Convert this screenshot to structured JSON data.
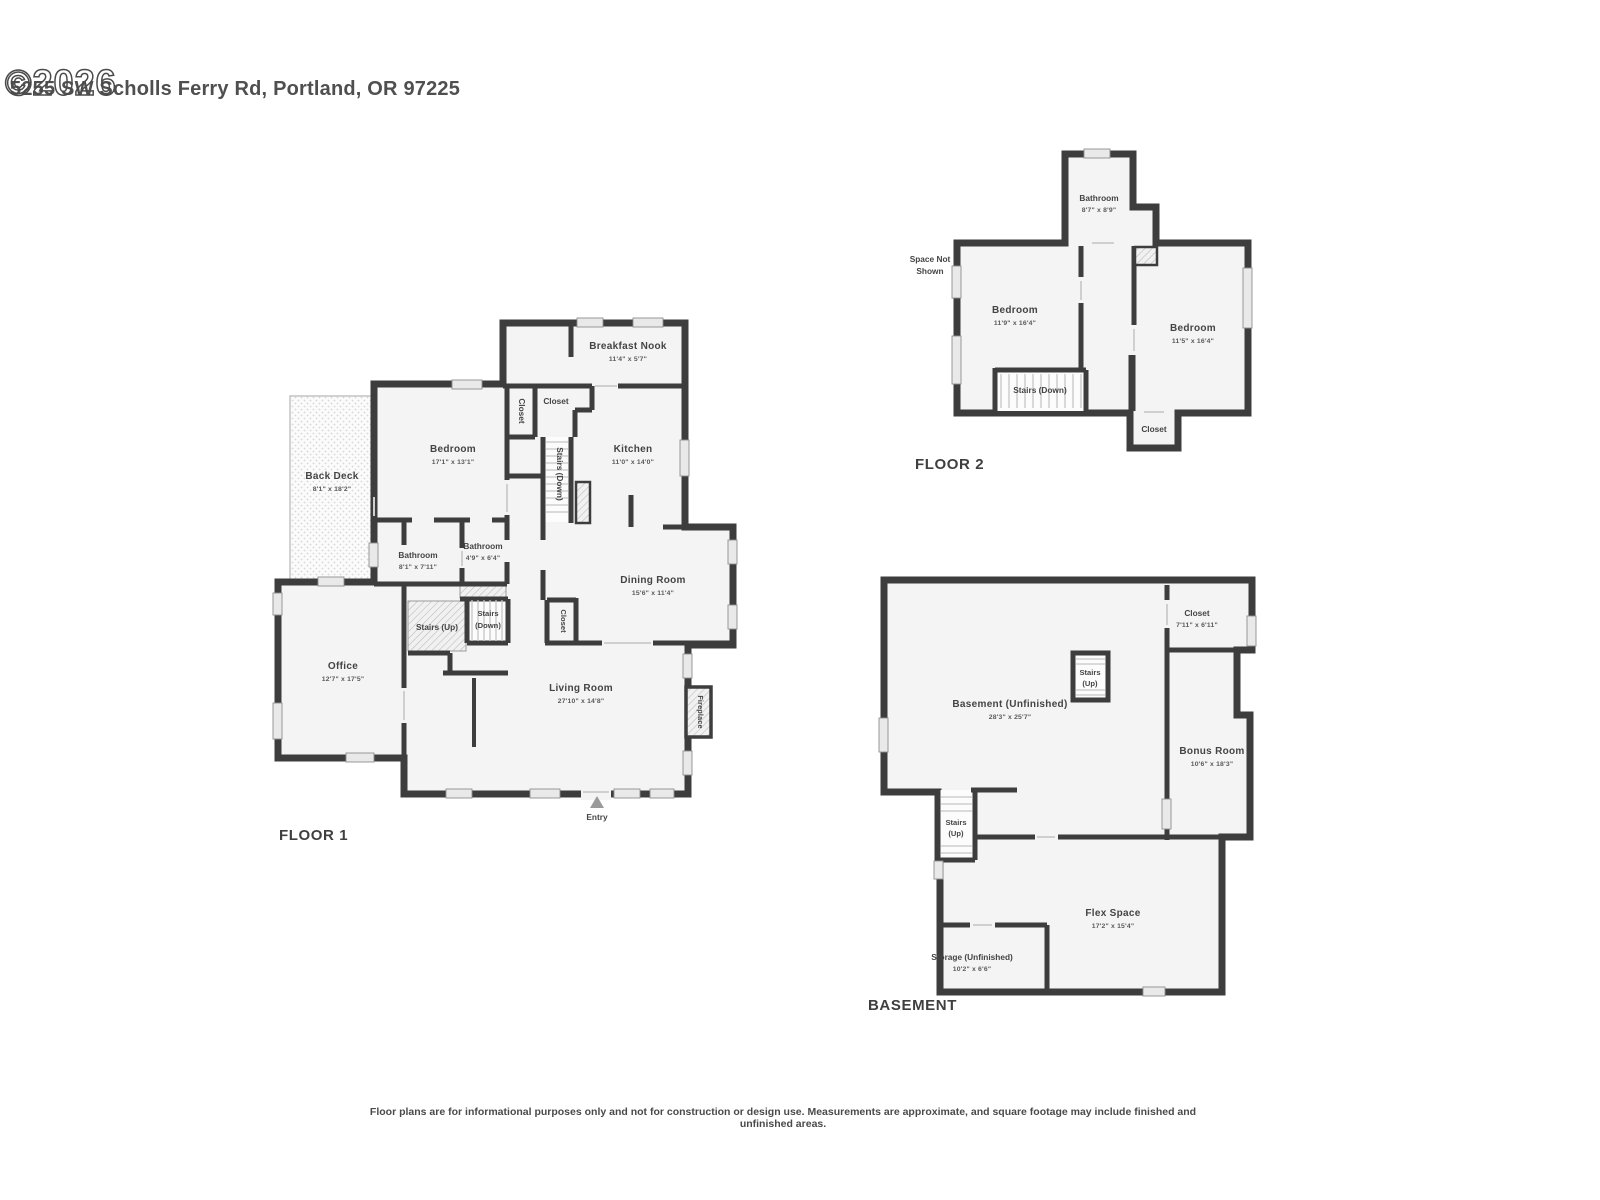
{
  "header": {
    "watermark": "©2026",
    "title": "5255 SW Scholls Ferry Rd, Portland, OR 97225"
  },
  "footer": {
    "disclaimer": "Floor plans are for informational purposes only and not for construction or design use. Measurements are approximate, and square footage may include finished and unfinished areas."
  },
  "colors": {
    "wall": "#3d3d3d",
    "room_fill": "#f4f4f4",
    "window": "#e9e9e9",
    "text": "#4a4a4a"
  },
  "floors": {
    "f1": {
      "label": "FLOOR 1",
      "rooms": {
        "breakfast_nook": {
          "name": "Breakfast Nook",
          "dims": "11'4\" x 5'7\""
        },
        "closet_a": {
          "name": "Closet"
        },
        "closet_b": {
          "name": "Closet"
        },
        "bedroom": {
          "name": "Bedroom",
          "dims": "17'1\" x 13'1\""
        },
        "kitchen": {
          "name": "Kitchen",
          "dims": "11'0\" x 14'0\""
        },
        "stairs_down_upper": {
          "name": "Stairs (Down)"
        },
        "back_deck": {
          "name": "Back Deck",
          "dims": "8'1\" x 18'2\""
        },
        "bathroom_a": {
          "name": "Bathroom",
          "dims": "8'1\" x 7'11\""
        },
        "bathroom_b": {
          "name": "Bathroom",
          "dims": "4'9\" x 6'4\""
        },
        "dining_room": {
          "name": "Dining Room",
          "dims": "15'6\" x 11'4\""
        },
        "stairs_up": {
          "name": "Stairs (Up)"
        },
        "stairs_down": {
          "line1": "Stairs",
          "line2": "(Down)"
        },
        "closet_c": {
          "name": "Closet"
        },
        "office": {
          "name": "Office",
          "dims": "12'7\" x 17'5\""
        },
        "living_room": {
          "name": "Living Room",
          "dims": "27'10\" x 14'8\""
        },
        "fireplace": {
          "name": "Fireplace"
        },
        "entry": {
          "name": "Entry"
        }
      }
    },
    "f2": {
      "label": "FLOOR 2",
      "rooms": {
        "bathroom": {
          "name": "Bathroom",
          "dims": "8'7\" x 8'9\""
        },
        "space_not_shown": {
          "line1": "Space Not",
          "line2": "Shown"
        },
        "bedroom_a": {
          "name": "Bedroom",
          "dims": "11'9\" x 16'4\""
        },
        "bedroom_b": {
          "name": "Bedroom",
          "dims": "11'5\" x 16'4\""
        },
        "stairs_down": {
          "name": "Stairs (Down)"
        },
        "closet": {
          "name": "Closet"
        }
      }
    },
    "b": {
      "label": "BASEMENT",
      "rooms": {
        "closet": {
          "name": "Closet",
          "dims": "7'11\" x 6'11\""
        },
        "stairs_up_center": {
          "line1": "Stairs",
          "line2": "(Up)"
        },
        "basement": {
          "name": "Basement (Unfinished)",
          "dims": "28'3\" x 25'7\""
        },
        "bonus_room": {
          "name": "Bonus Room",
          "dims": "10'6\" x 18'3\""
        },
        "stairs_up_left": {
          "line1": "Stairs",
          "line2": "(Up)"
        },
        "flex_space": {
          "name": "Flex Space",
          "dims": "17'2\" x 15'4\""
        },
        "storage": {
          "name": "Storage (Unfinished)",
          "dims": "10'2\" x 6'6\""
        }
      }
    }
  }
}
